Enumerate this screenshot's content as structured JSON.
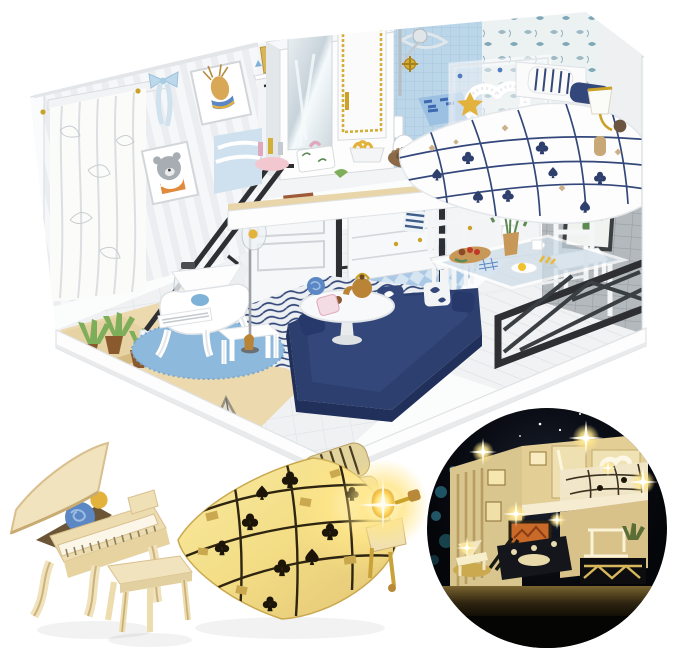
{
  "meta": {
    "type": "product-photo",
    "subject": "DIY miniature loft dollhouse kit with furniture and LED lighting"
  },
  "palette": {
    "white": "#ffffff",
    "frame_grey": "#d7dade",
    "wall_base": "#f5f6f8",
    "wall_stripe": "#e9ebee",
    "curtain": "#fbfbfa",
    "wood": "#ecd9ae",
    "wood_deep": "#dcc28c",
    "tile_floor": "#eff1f3",
    "kitchen_blue": "#cfe1f0",
    "kitchen_blue_dark": "#a9c8e6",
    "bath_tile": "#bcd6e9",
    "grey_wall": "#b3b8bc",
    "navy": "#2c3f6e",
    "navy_deep": "#20305a",
    "rug_blue": "#8db9dd",
    "metal_black": "#2d2f33",
    "gold": "#c9a227",
    "red": "#d43a2a",
    "green": "#7fae5a",
    "pink": "#f2b8c6",
    "cream": "#f1e3bd",
    "cream_shadow": "#d9bf8e",
    "blanket_glow": "#f7e28a",
    "glow": "#ffd75e",
    "night_sky": "#0a0c12",
    "night_warm": "#e3cf96",
    "bokeh_teal": "#2e7f96"
  },
  "scene": {
    "background": "#ffffff",
    "main_house": {
      "label": "Miniature two-storey loft dollhouse diorama, white and navy theme",
      "left_wall": {
        "art": [
          "deer portrait",
          "bear portrait"
        ],
        "decor": [
          "white curtain",
          "light blue ribbon bow",
          "gold pins"
        ]
      },
      "upper_floor": {
        "items": [
          "wardrobe with mirror door",
          "blue tiled shower with gold faucet",
          "toilet",
          "white heart wreath board with gold star",
          "double bed with navy grid blanket and card-suit print",
          "striped pillows",
          "gold wall lamp",
          "vanity desk with cosmetics and tissue box",
          "clothes rack with hangers",
          "shelf with books"
        ]
      },
      "lower_floor": {
        "items": [
          "black steel staircase",
          "white grand piano",
          "piano stool",
          "round blue rug",
          "potted plants",
          "glass triangle ornament",
          "floor lamp",
          "navy corner sofa with leaf pillows",
          "striped rug",
          "round white coffee table",
          "teapot",
          "white kitchen cabinets",
          "blue checkered kitchen floor",
          "glass dining table with breakfast",
          "two white chairs",
          "red tulips",
          "cactus wall art",
          "dark chevron railing",
          "wooden display base"
        ]
      }
    },
    "closeup_piano": {
      "label": "Close-up of unpainted cream grand piano with blue rose and stool"
    },
    "closeup_bed": {
      "label": "Close-up of miniature bed with glowing blanket and lit bedside lamp"
    },
    "night_inset": {
      "label": "Circular inset of the dollhouse illuminated at night",
      "sky": "starry night sky",
      "lighting": "warm LED sparkle lights"
    }
  }
}
